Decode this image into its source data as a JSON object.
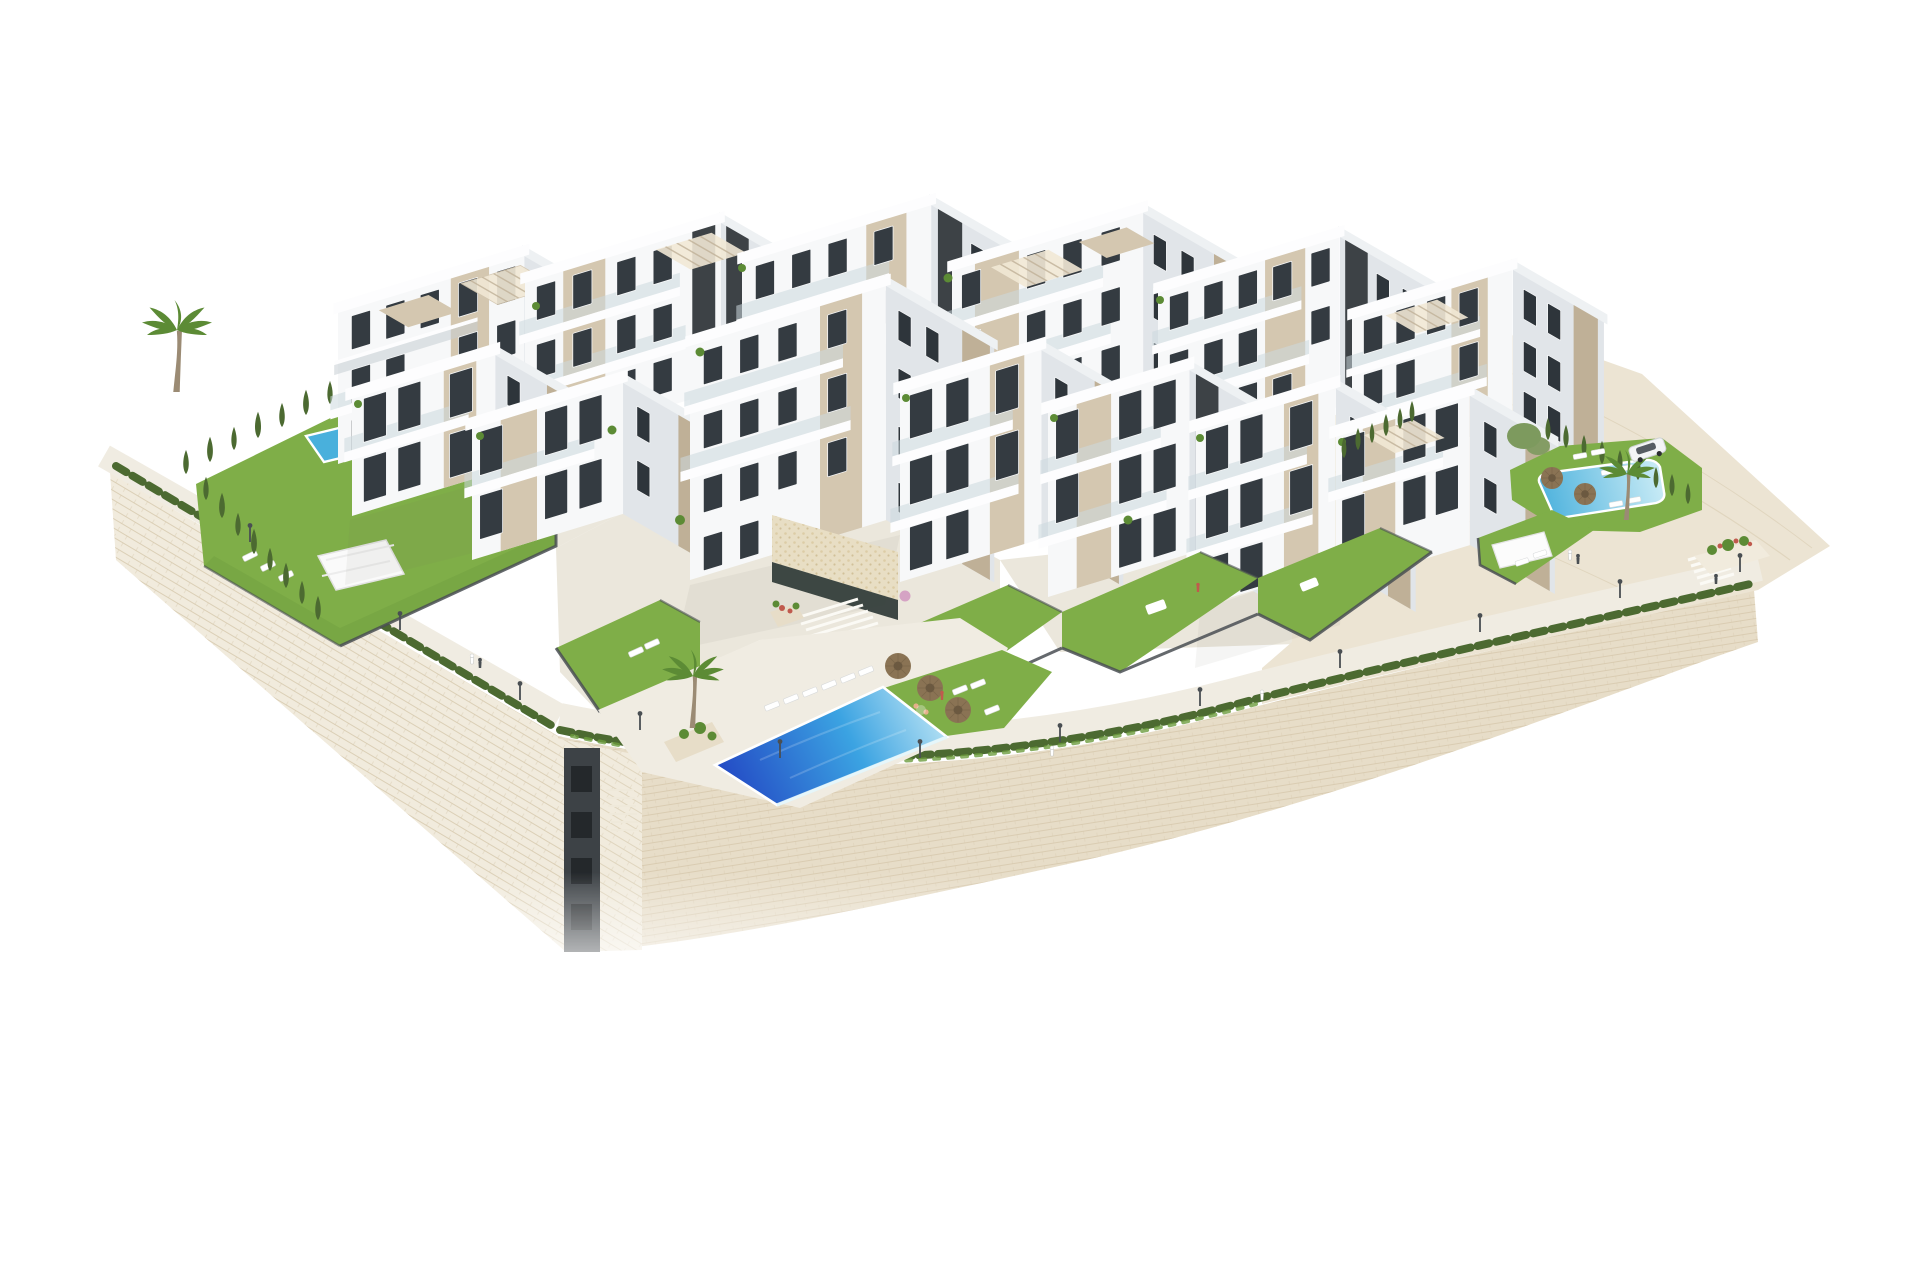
{
  "title": "Aerial 3D architectural rendering of a hillside residential complex",
  "scene": {
    "setting": "Modern white low-rise apartment complex built on a terraced hillside, surrounded by cream stone retaining walls, with landscaped gardens, a lower promenade walkway and swimming pools, isolated on a pure white background",
    "objects": {
      "apartment_blocks": 13,
      "swimming_pools": 3,
      "straw_umbrellas": 5,
      "shade_sails": 2,
      "roof_pergolas": 5,
      "palm_trees": 4,
      "cypress_trees": 30,
      "lamp_posts": 12,
      "people": 12,
      "parked_cars": 1
    }
  },
  "palette": {
    "background": "#ffffff",
    "stone_light": "#f1ebdd",
    "stone_mid": "#e7ddc8",
    "stone_course": "#d2c4a6",
    "paving": "#ebe7dc",
    "paving_warm": "#ece4d3",
    "walkway": "#f0ece2",
    "building_white": "#f7f8f9",
    "building_side": "#e1e5e9",
    "building_deep_shade": "#c6ccd3",
    "accent_beige": "#d4c7b0",
    "accent_beige_shade": "#bfb097",
    "dark_core": "#3d4246",
    "window_glass": "#343b41",
    "window_side": "#2e353b",
    "grass": "#7fae48",
    "grass_shade": "#6d9c3e",
    "hedge": "#4c6a31",
    "tree_soft": "#7d9a5e",
    "palm_green": "#5c8b35",
    "trunk": "#9b8b74",
    "pool_deep": "#2348c4",
    "pool_mid": "#3ba3e2",
    "pool_light": "#cfeef7",
    "pool_small": "#49b0dc",
    "umbrella_straw": "#8a7354",
    "fence_dark": "#4a4f53",
    "flower_pink": "#d5a3c4",
    "flower_red": "#c05a4d",
    "car_body": "#f3f4f5",
    "skin": "#e5b08a",
    "entrance_dark": "#2f3a36",
    "mosaic_wall": "#e8dec4"
  }
}
